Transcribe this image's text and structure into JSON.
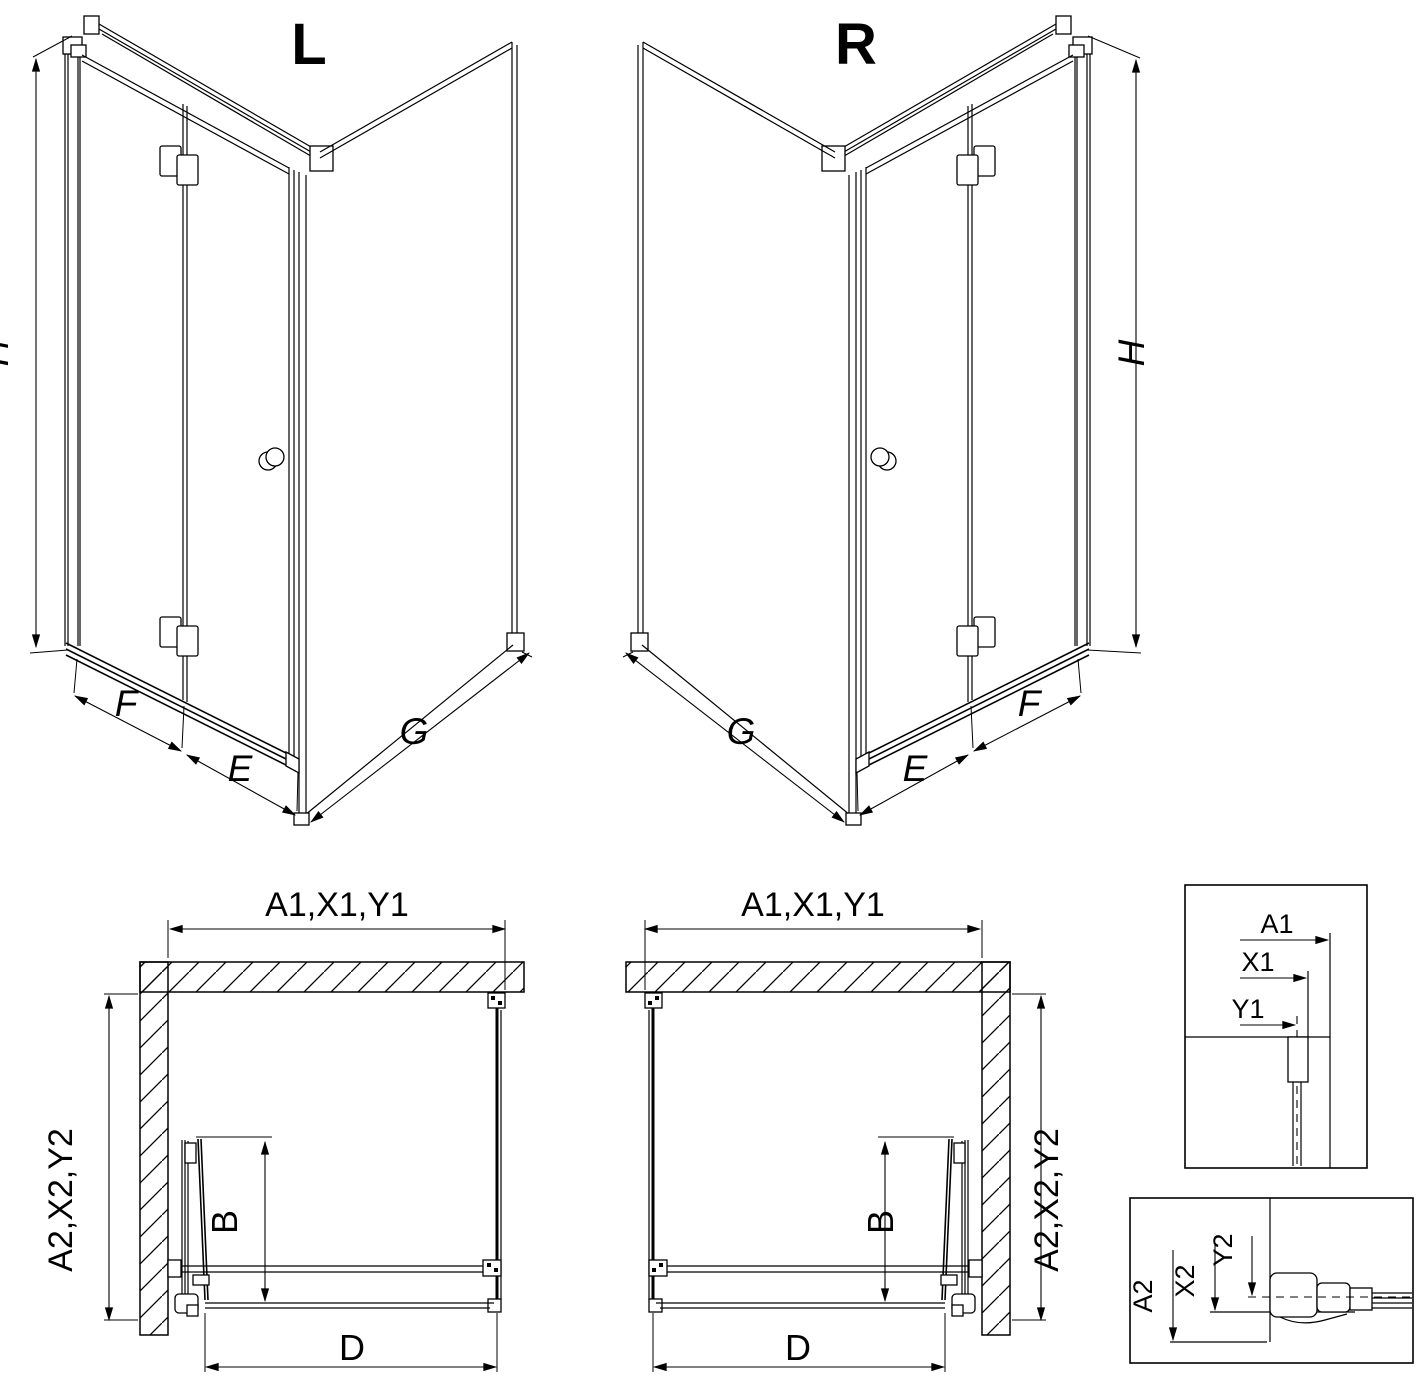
{
  "drawing": {
    "background": "#ffffff",
    "line_color": "#000000",
    "iso_left": {
      "variant_label": "L",
      "height_label": "H",
      "fixed_label": "F",
      "door_label": "E",
      "side_label": "G"
    },
    "iso_right": {
      "variant_label": "R",
      "height_label": "H",
      "fixed_label": "F",
      "door_label": "E",
      "side_label": "G"
    },
    "plan_left": {
      "width_label": "A1,X1,Y1",
      "depth_label": "A2,X2,Y2",
      "entry_label": "B",
      "front_label": "D"
    },
    "plan_right": {
      "width_label": "A1,X1,Y1",
      "depth_label": "A2,X2,Y2",
      "entry_label": "B",
      "front_label": "D"
    },
    "detail_width": {
      "labels": [
        "A1",
        "X1",
        "Y1"
      ]
    },
    "detail_depth": {
      "labels": [
        "A2",
        "X2",
        "Y2"
      ]
    }
  }
}
